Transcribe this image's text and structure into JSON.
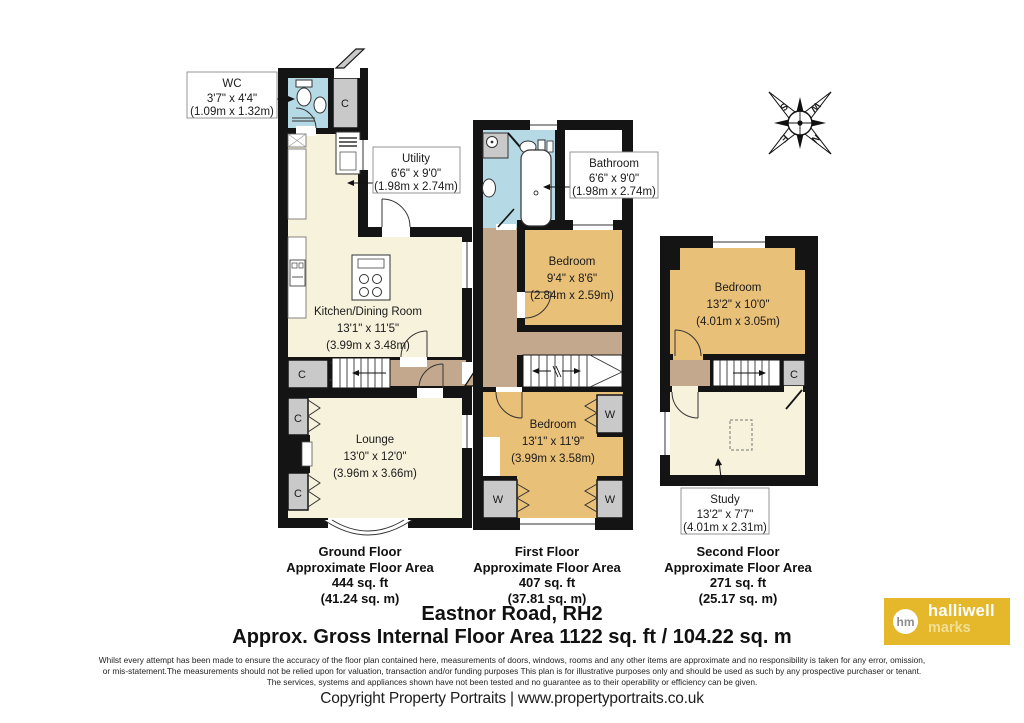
{
  "address": "Eastnor Road, RH2",
  "gross_area": "Approx. Gross Internal Floor Area 1122 sq. ft / 104.22 sq. m",
  "compass": {
    "n": "N",
    "e": "E",
    "s": "S",
    "w": "W"
  },
  "closets": {
    "c": "C",
    "w": "W"
  },
  "rooms": {
    "wc": {
      "name": "WC",
      "ft": "3'7\" x 4'4\"",
      "m": "(1.09m x 1.32m)"
    },
    "utility": {
      "name": "Utility",
      "ft": "6'6\" x 9'0\"",
      "m": "(1.98m x 2.74m)"
    },
    "kitchen": {
      "name": "Kitchen/Dining Room",
      "ft": "13'1\" x 11'5\"",
      "m": "(3.99m x 3.48m)"
    },
    "lounge": {
      "name": "Lounge",
      "ft": "13'0\" x 12'0\"",
      "m": "(3.96m x 3.66m)"
    },
    "bathroom": {
      "name": "Bathroom",
      "ft": "6'6\" x 9'0\"",
      "m": "(1.98m x 2.74m)"
    },
    "bedroom1": {
      "name": "Bedroom",
      "ft": "9'4\" x 8'6\"",
      "m": "(2.84m x 2.59m)"
    },
    "bedroom2": {
      "name": "Bedroom",
      "ft": "13'1\" x 11'9\"",
      "m": "(3.99m x 3.58m)"
    },
    "bedroom3": {
      "name": "Bedroom",
      "ft": "13'2\" x 10'0\"",
      "m": "(4.01m x 3.05m)"
    },
    "study": {
      "name": "Study",
      "ft": "13'2\" x 7'7\"",
      "m": "(4.01m x 2.31m)"
    }
  },
  "floors": [
    {
      "name": "Ground Floor",
      "approx": "Approximate Floor Area",
      "sqft": "444 sq. ft",
      "sqm": "(41.24 sq. m)"
    },
    {
      "name": "First Floor",
      "approx": "Approximate Floor Area",
      "sqft": "407 sq. ft",
      "sqm": "(37.81 sq. m)"
    },
    {
      "name": "Second Floor",
      "approx": "Approximate Floor Area",
      "sqft": "271 sq. ft",
      "sqm": "(25.17 sq. m)"
    }
  ],
  "disclaimer": [
    "Whilst every attempt has been made to ensure the accuracy of the floor plan contained here, measurements of doors, windows, rooms and any other items are approximate and no responsibility is taken for any error, omission,",
    "or mis-statement.The measurements should not be relied upon for valuation, transaction and/or funding purposes This plan is for illustrative purposes only and should be used as such by any prospective purchaser or tenant.",
    "The services, systems and appliances shown have not been tested and no guarantee as to their operability or efficiency can be given."
  ],
  "copyright": "Copyright Property Portraits | www.propertyportraits.co.uk",
  "logo": {
    "initials": "hm",
    "line1": "halliwell",
    "line2": "marks"
  },
  "colors": {
    "wall": "#141414",
    "cream": "#F7F2DC",
    "blue": "#B5DAE6",
    "tan": "#E9C078",
    "brown": "#C4A88D",
    "closet": "#C9C9C9",
    "logo_gold": "#E5B82B",
    "logo_pale": "#F2DF94"
  }
}
